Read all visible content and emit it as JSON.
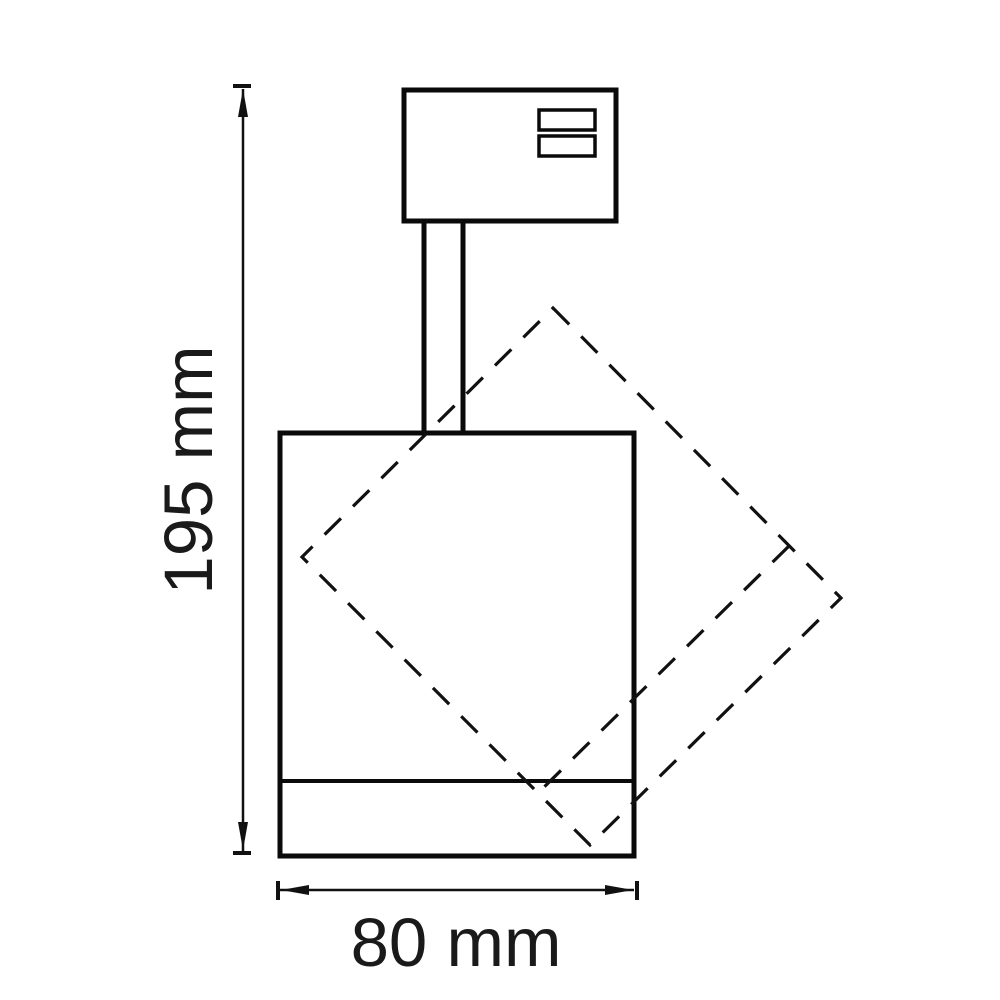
{
  "page": {
    "background": "#ffffff",
    "line_color": "#0a0a0a",
    "text_color": "#1a1a1a"
  },
  "drawing": {
    "kind": "track-spotlight-dimension-drawing",
    "dimensions": {
      "height": {
        "label": "195 mm",
        "value": 195,
        "unit": "mm"
      },
      "width": {
        "label": "80 mm",
        "value": 80,
        "unit": "mm"
      }
    }
  }
}
